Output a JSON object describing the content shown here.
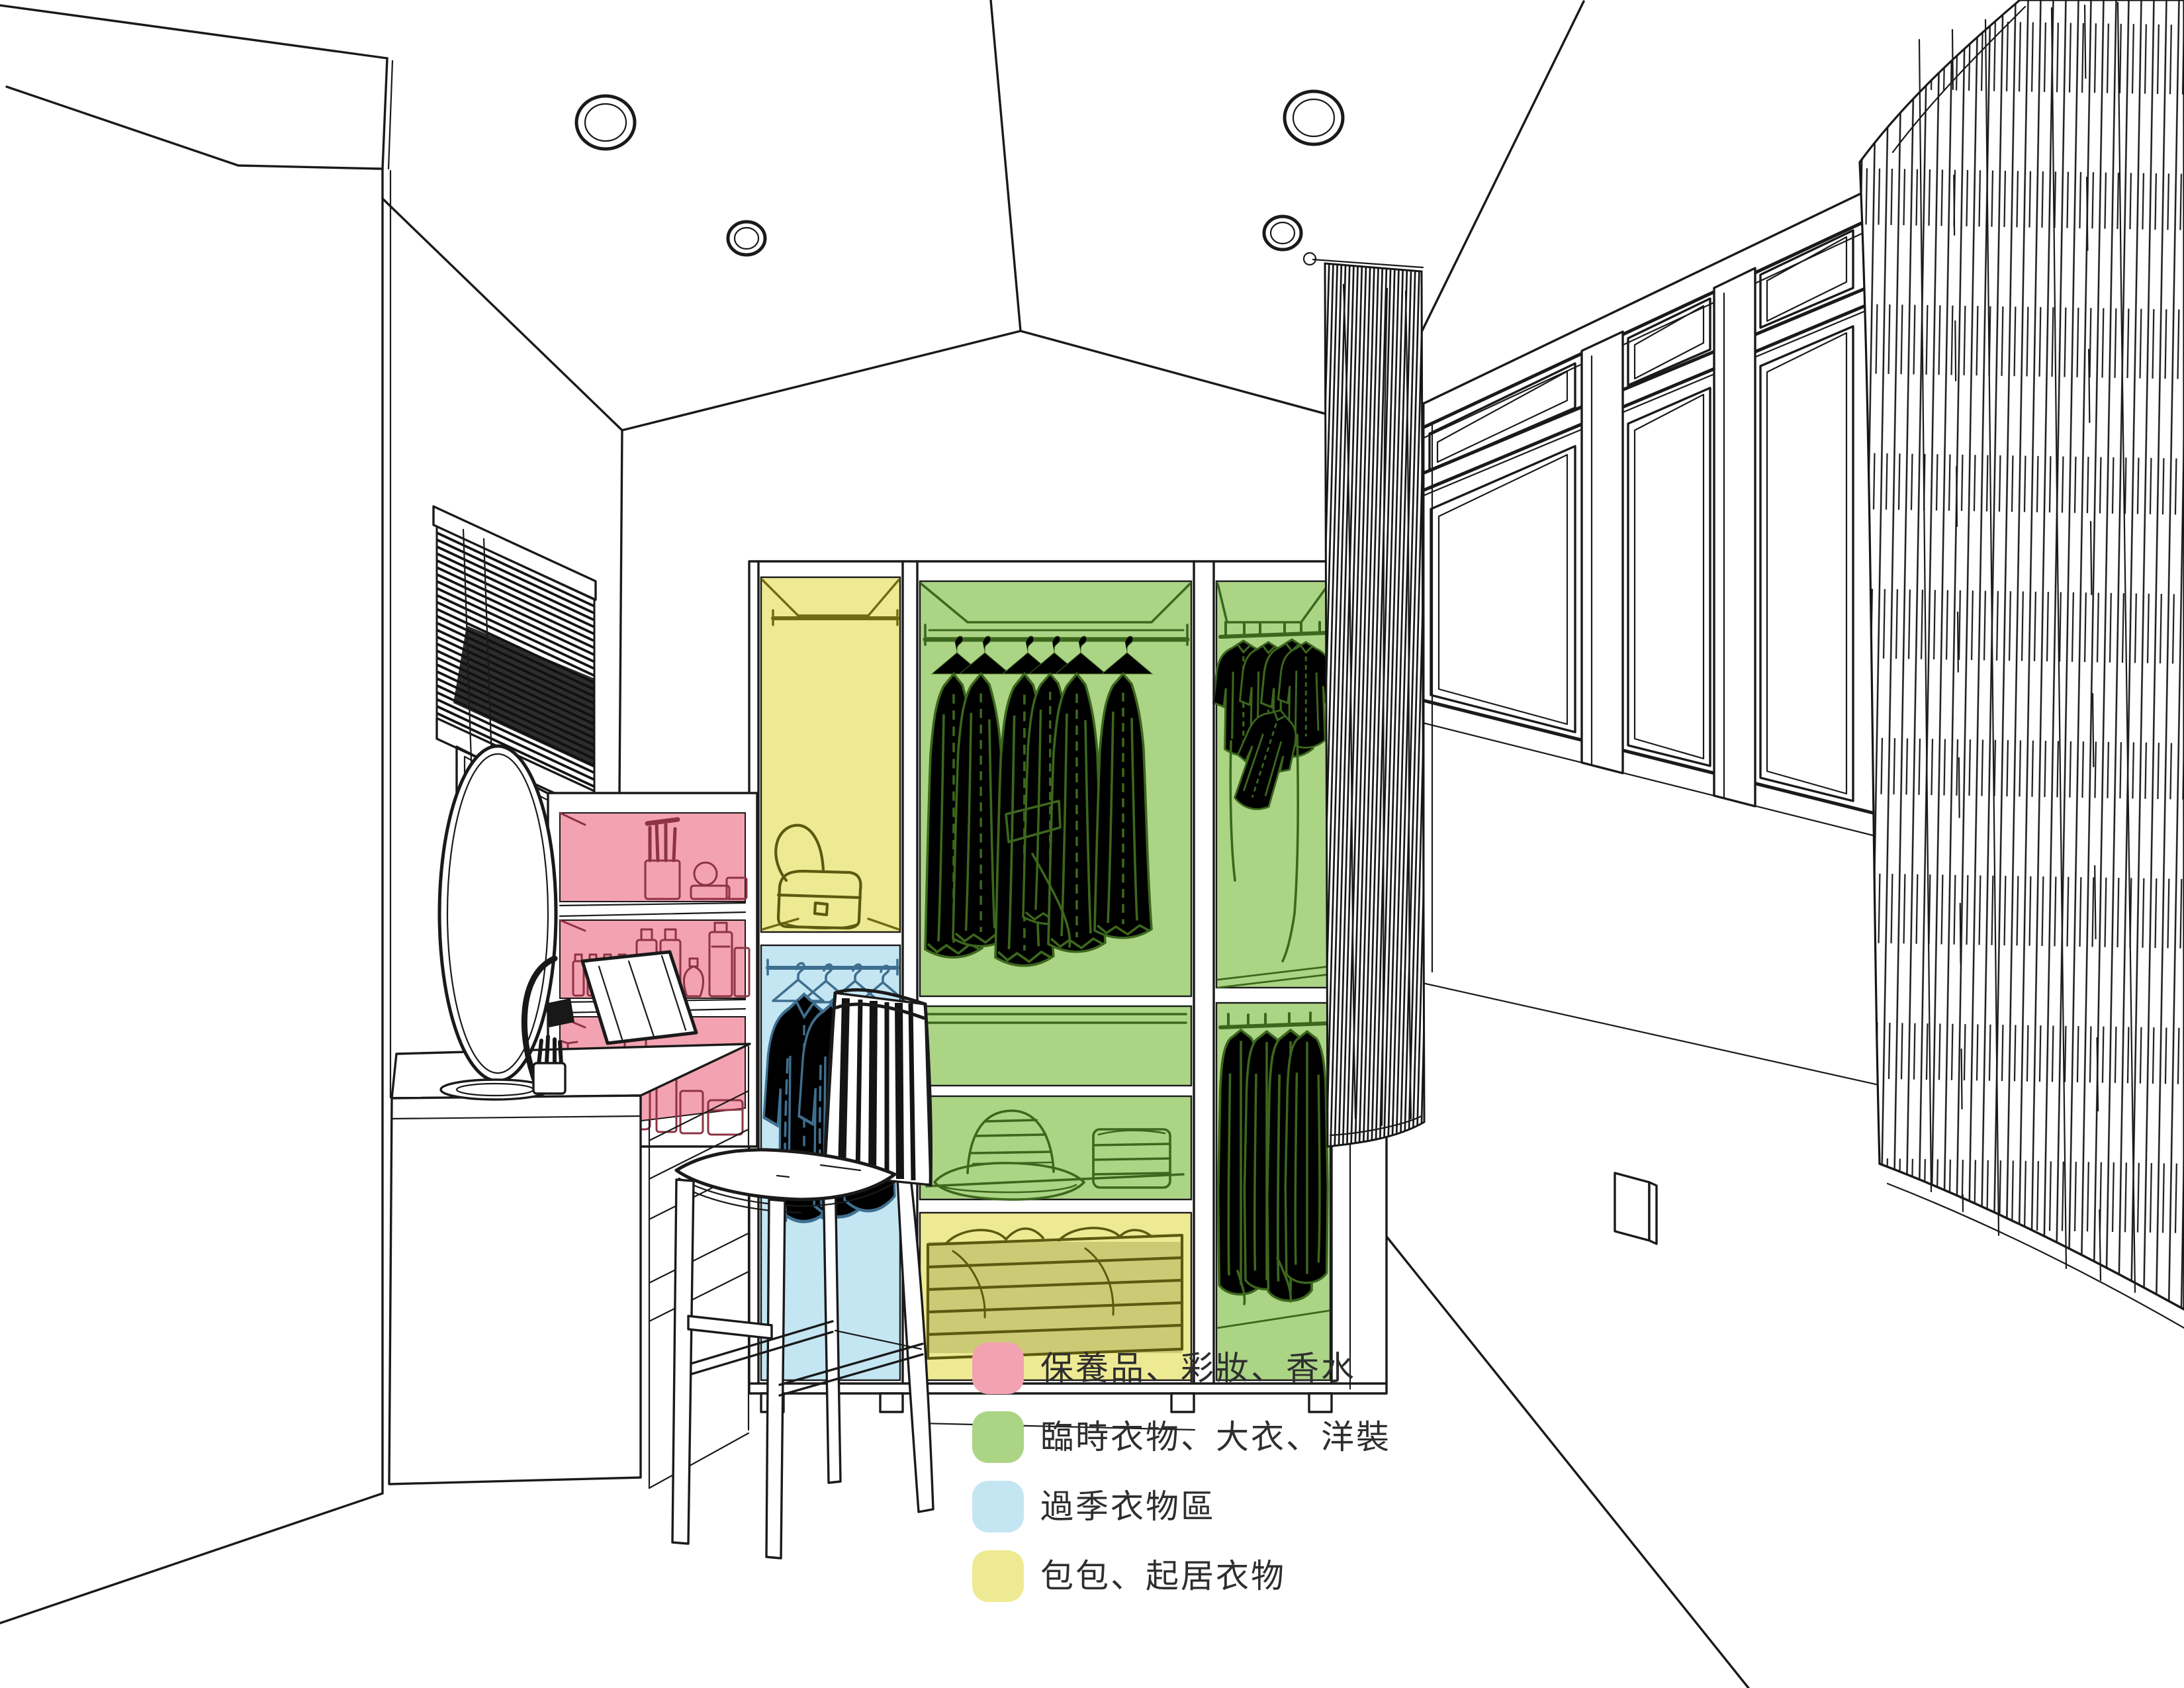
{
  "scene": {
    "background": "#ffffff",
    "line_color": "#1a1a1a"
  },
  "zones": {
    "pink": "#f3a2b1",
    "green": "#abd485",
    "blue": "#c4e6f3",
    "yellow": "#eeea93"
  },
  "line_art_colors": {
    "pink_items": "#8e3344",
    "green_items": "#3c671d",
    "blue_items": "#3f6f8f",
    "yellow_items": "#6f6b12",
    "olive_items": "#5c5a10"
  },
  "legend": {
    "items": [
      {
        "name": "zone-cosmetics",
        "color": "#f3a2b1",
        "label": "保養品、彩妝、香水"
      },
      {
        "name": "zone-daily-coats-dresses",
        "color": "#abd485",
        "label": "臨時衣物、大衣、洋裝"
      },
      {
        "name": "zone-off-season",
        "color": "#c4e6f3",
        "label": "過季衣物區"
      },
      {
        "name": "zone-bags-loungewear",
        "color": "#eeea93",
        "label": "包包、起居衣物"
      }
    ]
  }
}
